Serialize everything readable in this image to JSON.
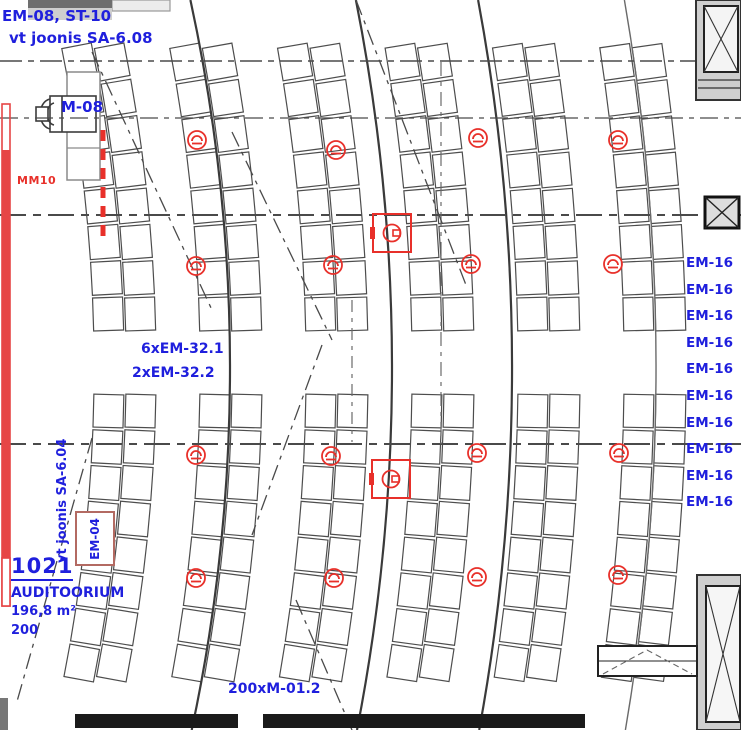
{
  "drawing_title": "Auditoorium valgustus/elektri plaan",
  "colors": {
    "annotation_blue": "#1f1fdd",
    "device_red": "#e8302a",
    "bar_red": "#e64545",
    "seat_line": "#4d4d4d",
    "grid_line": "#444444"
  },
  "room": {
    "number": "1021",
    "name": "AUDITOORIUM",
    "area": "196,8 m²",
    "capacity": "200"
  },
  "labels": {
    "top_left_ref": "EM-08, ST-10",
    "top_left_note": "vt joonis SA-6.08",
    "fan_tag": "M-08",
    "duct_tag": "MM10",
    "mid_note1": "6xEM-32.1",
    "mid_note2": "2xEM-32.2",
    "seat_type_note": "200xM-01.2",
    "em04_tag": "EM-04",
    "side_ref": "vt joonis SA-6.04"
  },
  "em16_list": [
    "EM-16",
    "EM-16",
    "EM-16",
    "EM-16",
    "EM-16",
    "EM-16",
    "EM-16",
    "EM-16",
    "EM-16",
    "EM-16"
  ],
  "symbols": {
    "speakers": [
      {
        "x": 197,
        "y": 140
      },
      {
        "x": 336,
        "y": 150
      },
      {
        "x": 478,
        "y": 138
      },
      {
        "x": 618,
        "y": 140
      },
      {
        "x": 196,
        "y": 266
      },
      {
        "x": 333,
        "y": 265
      },
      {
        "x": 471,
        "y": 264
      },
      {
        "x": 613,
        "y": 264
      },
      {
        "x": 196,
        "y": 455
      },
      {
        "x": 331,
        "y": 456
      },
      {
        "x": 477,
        "y": 453
      },
      {
        "x": 619,
        "y": 453
      },
      {
        "x": 196,
        "y": 578
      },
      {
        "x": 334,
        "y": 578
      },
      {
        "x": 477,
        "y": 577
      },
      {
        "x": 618,
        "y": 575
      }
    ],
    "junction_boxes": [
      {
        "x": 392,
        "y": 233
      },
      {
        "x": 391,
        "y": 479
      }
    ]
  }
}
